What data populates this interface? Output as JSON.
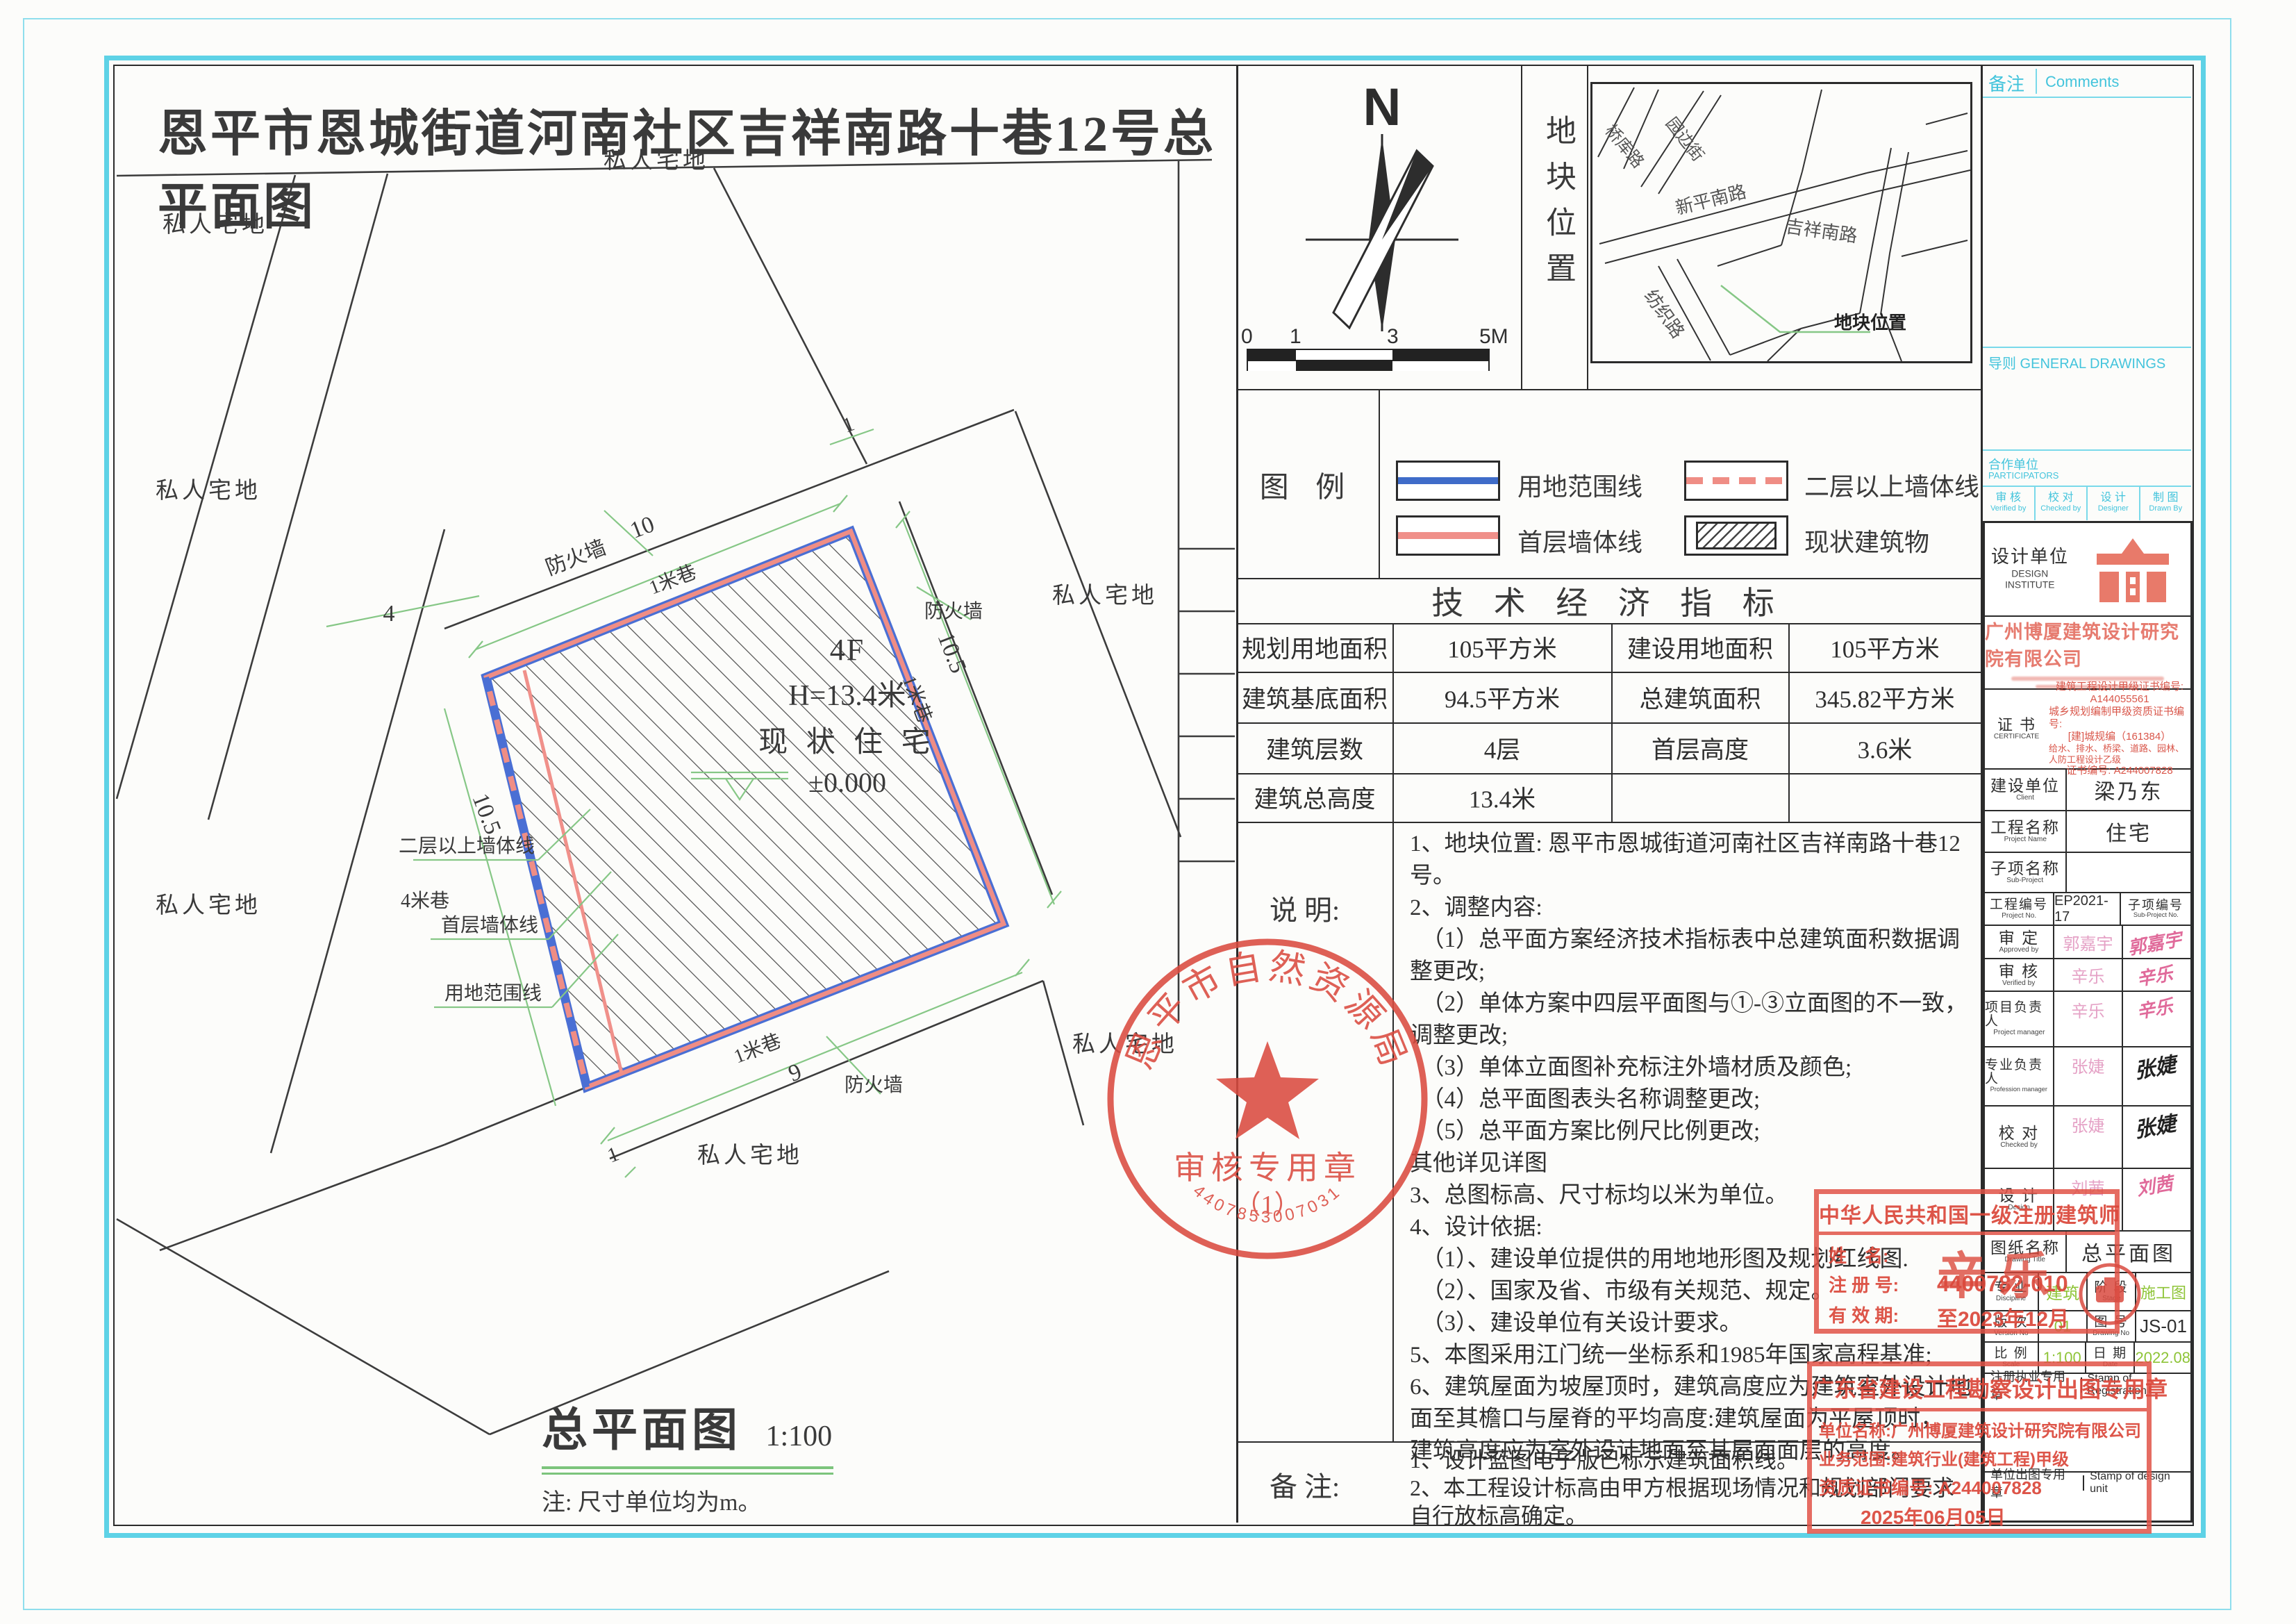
{
  "title": "恩平市恩城街道河南社区吉祥南路十巷12号总平面图",
  "plan": {
    "parcel_label": "私人宅地",
    "building": {
      "floors": "4F",
      "height": "H=13.4米",
      "status": "现 状 住 宅",
      "level": "±0.000"
    },
    "plan_name": "总平面图",
    "plan_scale": "1:100",
    "plan_note": "注: 尺寸单位均为m。",
    "annotations": {
      "firewall": "防火墙",
      "dim10": "10",
      "lane1": "1米巷",
      "dim4": "4",
      "lane4": "4米巷",
      "dim105": "10.5",
      "wall2": "二层以上墙体线",
      "wall1": "首层墙体线",
      "boundary": "用地范围线",
      "dim9": "9",
      "dim1": "1"
    }
  },
  "compass": {
    "north": "N",
    "ticks": [
      "0",
      "1",
      "3",
      "5M"
    ]
  },
  "location": {
    "label": "地块位置",
    "roads": [
      "桥库路",
      "园边街",
      "新平南路",
      "吉祥南路",
      "纺织路"
    ],
    "marker": "地块位置"
  },
  "legend": {
    "label": "图  例",
    "items": [
      {
        "name": "用地范围线"
      },
      {
        "name": "二层以上墙体线"
      },
      {
        "name": "首层墙体线"
      },
      {
        "name": "现状建筑物"
      }
    ]
  },
  "tech": {
    "title": "技 术 经 济 指 标",
    "rows": [
      [
        "规划用地面积",
        "105平方米",
        "建设用地面积",
        "105平方米"
      ],
      [
        "建筑基底面积",
        "94.5平方米",
        "总建筑面积",
        "345.82平方米"
      ],
      [
        "建筑层数",
        "4层",
        "首层高度",
        "3.6米"
      ],
      [
        "建筑总高度",
        "13.4米",
        "",
        ""
      ]
    ]
  },
  "notes": {
    "label": "说  明:",
    "lines": [
      "1、地块位置: 恩平市恩城街道河南社区吉祥南路十巷12号。",
      "2、调整内容:",
      "　（1）总平面方案经济技术指标表中总建筑面积数据调整更改;",
      "　（2）单体方案中四层平面图与①-③立面图的不一致，",
      "调整更改;",
      "　（3）单体立面图补充标注外墙材质及颜色;",
      "　（4）总平面图表头名称调整更改;",
      "　（5）总平面方案比例尺比例更改;",
      "其他详见详图",
      "3、总图标高、尺寸标均以米为单位。",
      "4、设计依据:",
      "　（1）、建设单位提供的用地地形图及规划红线图.",
      "　（2）、国家及省、市级有关规范、规定。",
      "　（3）、建设单位有关设计要求。",
      "5、本图采用江门统一坐标系和1985年国家高程基准;",
      "6、建筑屋面为坡屋顶时，建筑高度应为建筑室外设计地",
      "面至其檐口与屋脊的平均高度:建筑屋面为平屋顶时，",
      "建筑高度应为室外设计地面至其屋面面层的高度。"
    ]
  },
  "remarks": {
    "label": "备  注:",
    "lines": [
      "1、设计蓝图电子版已标示建筑面积线。",
      "2、本工程设计标高由甲方根据现场情况和规划部门要求",
      "自行放标高确定。"
    ]
  },
  "preprint": {
    "comments_zh": "备注",
    "comments_en": "Comments",
    "general": "导则 GENERAL DRAWINGS",
    "participators_zh": "合作单位",
    "participators_en": "PARTICIPATORS",
    "col1_zh": "审 核",
    "col1_en": "Verified by",
    "col2_zh": "校 对",
    "col2_en": "Checked by",
    "col3_zh": "设 计",
    "col3_en": "Designer",
    "col4_zh": "制 图",
    "col4_en": "Drawn By"
  },
  "titleblock": {
    "institute_zh": "设计单位",
    "institute_en1": "DESIGN",
    "institute_en2": "INSTITUTE",
    "company": "广州博厦建筑设计研究院有限公司",
    "cert_zh": "证 书",
    "cert_en": "CERTIFICATE",
    "cert_lines": [
      "建筑工程设计甲级证书编号:",
      "A144055561",
      "城乡规划编制甲级资质证书编号:",
      "[建]城规编（161384）",
      "给水、排水、桥梁、道路、园林、人防工程设计乙级",
      "证书编号: A244007828"
    ],
    "client_zh": "建设单位",
    "client_en": "Client",
    "client": "梁乃东",
    "project_zh": "工程名称",
    "project_en": "Project Name",
    "project": "住宅",
    "sub_zh": "子项名称",
    "sub_en": "Sub-Project",
    "pno_zh": "工程编号",
    "pno_en": "Project No.",
    "pno": "EP2021-17",
    "sno_zh": "子项编号",
    "sno_en": "Sub-Project No.",
    "approved_zh": "审 定",
    "approved_en": "Approved by",
    "approved": "郭嘉宇",
    "verified_zh": "审 核",
    "verified_en": "Verified by",
    "verified": "辛乐",
    "pm_zh": "项目负责人",
    "pm_en": "Project manager",
    "pm": "辛乐",
    "prof_zh": "专业负责人",
    "prof_en": "Profession manager",
    "prof": "张婕",
    "checked_zh": "校 对",
    "checked_en": "Checked by",
    "checked": "张婕",
    "designer_zh": "设 计",
    "designer_en": "Design",
    "designer": "刘茜",
    "dtitle_zh": "图纸名称",
    "dtitle_en": "Drawing Title",
    "dtitle": "总平面图",
    "disc_zh": "专 业",
    "disc_en": "Discipline",
    "disc": "建筑",
    "stage_zh": "阶 段",
    "stage_en": "Stage",
    "stage": "施工图",
    "ver_zh": "版 次",
    "ver_en": "Version No",
    "ver": "01",
    "dno_zh": "图 号",
    "dno_en": "Drawing No",
    "dno": "JS-01",
    "scale_zh": "比 例",
    "scale_en": "Scale",
    "scale": "1:100",
    "date_zh": "日 期",
    "date_en": "Date",
    "date": "2022.08",
    "regstamp_zh": "注册执业专用章",
    "regstamp_en": "Stamp of Registration",
    "unitstamp_zh": "单位出图专用章",
    "unitstamp_en": "Stamp of design unit"
  },
  "stamps": {
    "round": {
      "top": "恩平市自然资源局",
      "mid": "审核专用章",
      "num": "（1）",
      "bottom": "4407853007031"
    },
    "architect": {
      "title": "中华人民共和国一级注册建筑师",
      "name_label": "姓　名:",
      "name": "辛 乐",
      "reg_label": "注 册 号:",
      "reg": "4400782-010",
      "valid_label": "有 效 期:",
      "valid": "至2023年12月"
    },
    "unit": {
      "title": "广东省建设工程勘察设计出图专用章",
      "line1": "单位名称:广州博厦建筑设计研究院有限公司",
      "line2": "业务范围:建筑行业(建筑工程)甲级",
      "line3": "资质证书编号: A244007828",
      "date": "2025年06月05日"
    }
  }
}
